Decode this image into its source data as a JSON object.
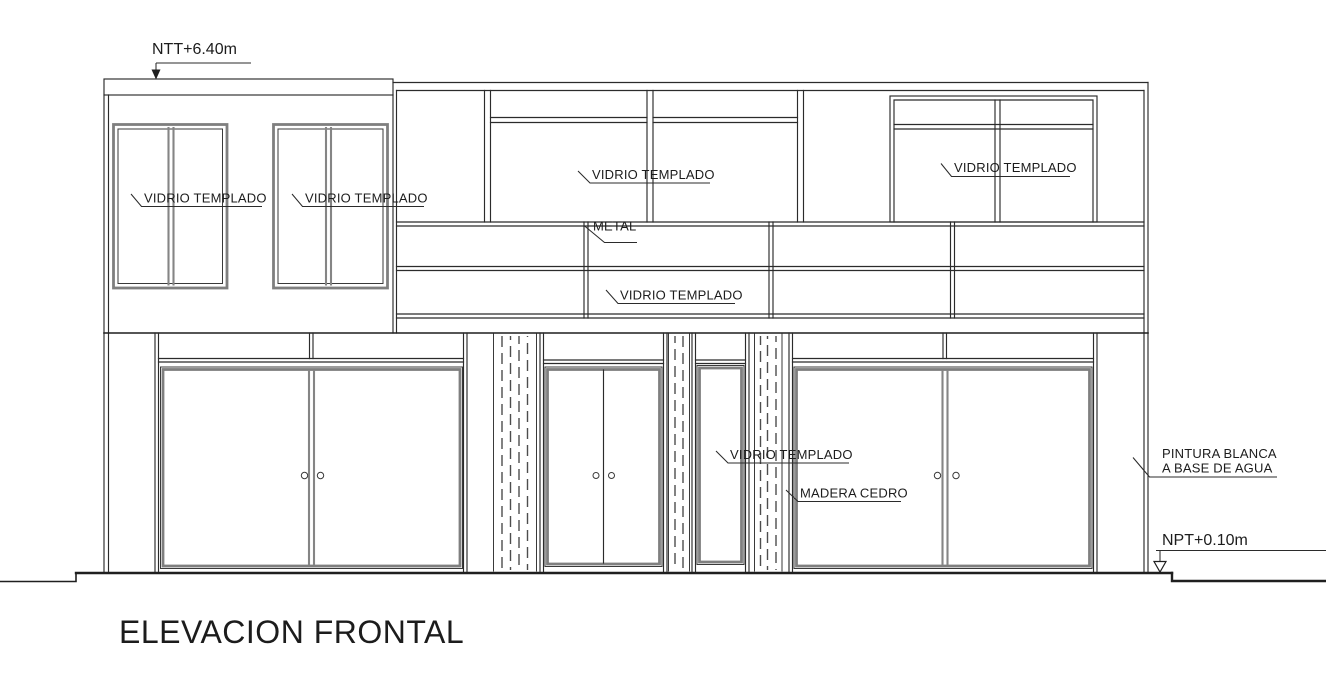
{
  "drawing": {
    "title": "ELEVACION FRONTAL",
    "level_top": "NTT+6.40m",
    "level_floor": "NPT+0.10m",
    "materials": {
      "glass": "VIDRIO TEMPLADO",
      "metal": "METAL",
      "wood": "MADERA CEDRO",
      "paint_line1": "PINTURA BLANCA",
      "paint_line2": "A BASE DE AGUA"
    },
    "colors": {
      "line": "#2b2b2b",
      "frame_gray": "#7f7f7f",
      "background": "#ffffff"
    }
  }
}
